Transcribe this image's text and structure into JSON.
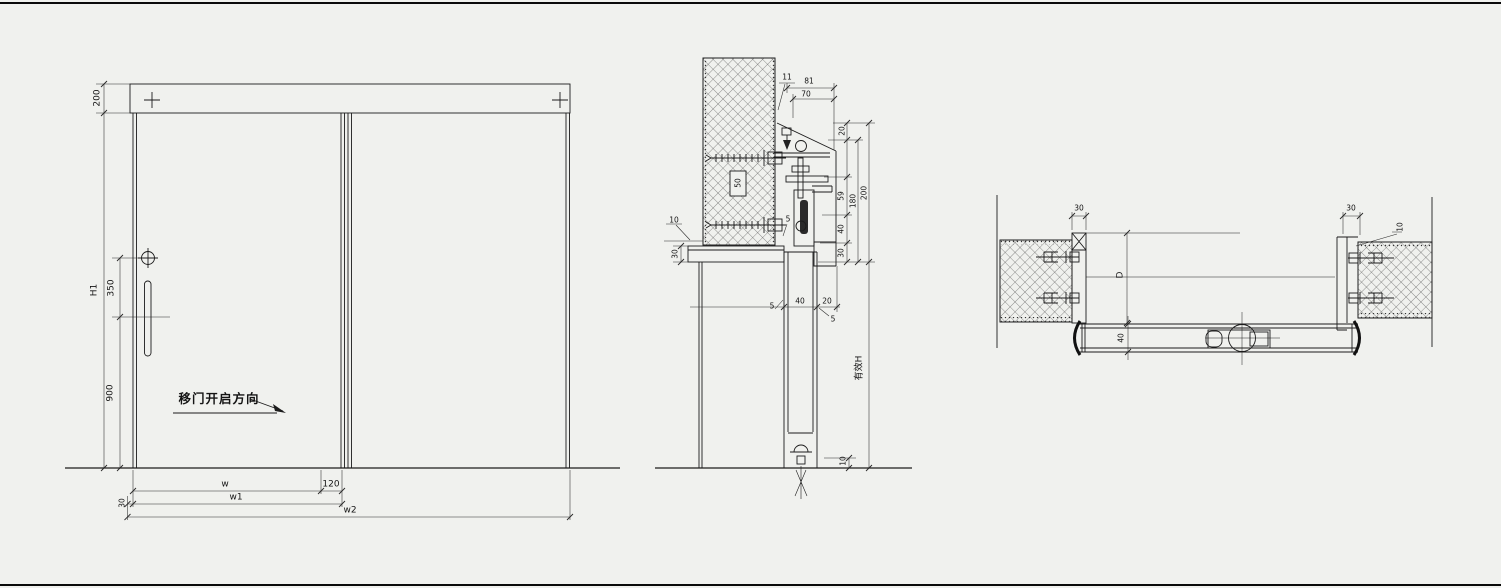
{
  "elevation": {
    "dim_top_rail": "200",
    "dim_door_height": "H1",
    "dim_handle_top": "350",
    "dim_handle_bottom": "900",
    "open_direction_note": "移门开启方向",
    "dim_panel_width": "w",
    "dim_overlap": "120",
    "dim_width_w1": "w1",
    "dim_width_w2": "w2",
    "dim_edge_gap": "30"
  },
  "section": {
    "dim_gap_11": "11",
    "dim_cover_81": "81",
    "dim_track_70": "70",
    "dim_top_20": "20",
    "dim_anchor_50": "50",
    "dim_hanger_59": "59",
    "dim_inner_180": "180",
    "dim_outer_200": "200",
    "dim_clear_40": "40",
    "dim_lintel_30_right": "30",
    "dim_wall_10": "10",
    "dim_lintel_30_left": "30",
    "dim_gap_5_top": "5",
    "dim_leaf_40": "40",
    "dim_clear_20": "20",
    "dim_gap_5_left": "5",
    "dim_gap_5_right": "5",
    "effective_height_label": "有效H",
    "dim_floor_10": "10"
  },
  "plan": {
    "dim_jamb_30_left": "30",
    "dim_opening_D": "D",
    "dim_leaf_40": "40",
    "dim_jamb_30_right": "30",
    "dim_gap_10": "10"
  }
}
